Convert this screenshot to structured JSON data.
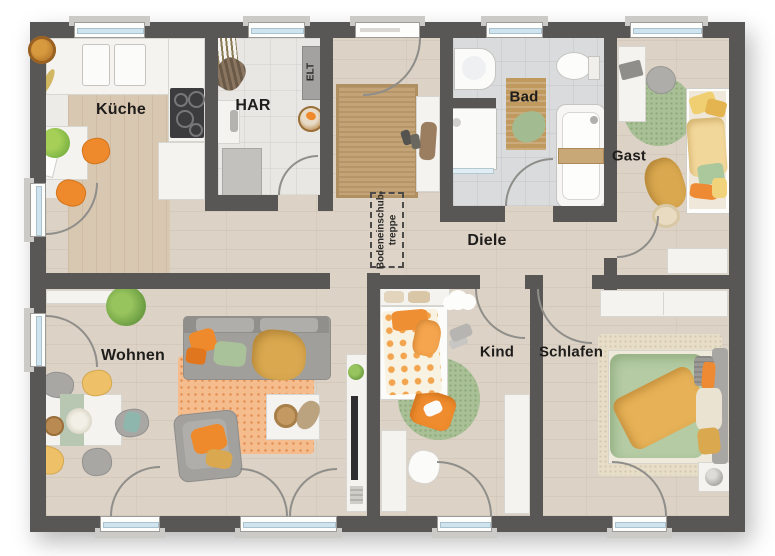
{
  "rooms": {
    "kueche": {
      "label": "Küche"
    },
    "har": {
      "label": "HAR"
    },
    "elt": {
      "label": "ELT"
    },
    "bad": {
      "label": "Bad"
    },
    "gast": {
      "label": "Gast"
    },
    "diele": {
      "label": "Diele"
    },
    "wohnen": {
      "label": "Wohnen"
    },
    "kind": {
      "label": "Kind"
    },
    "schlafen": {
      "label": "Schlafen"
    }
  },
  "attic_hatch": {
    "line1": "Bodeneinschub-",
    "line2": "treppe"
  },
  "colors": {
    "wall": "#595756",
    "floor_wood": "#dcd2c5",
    "floor_tile_utility": "#e8e7e4",
    "floor_tile_bath": "#d9dbdd",
    "window_glass": "#cfe4ee",
    "accent_orange": "#ee8a2b",
    "accent_green": "#a9c096",
    "accent_yellow": "#eec169"
  }
}
